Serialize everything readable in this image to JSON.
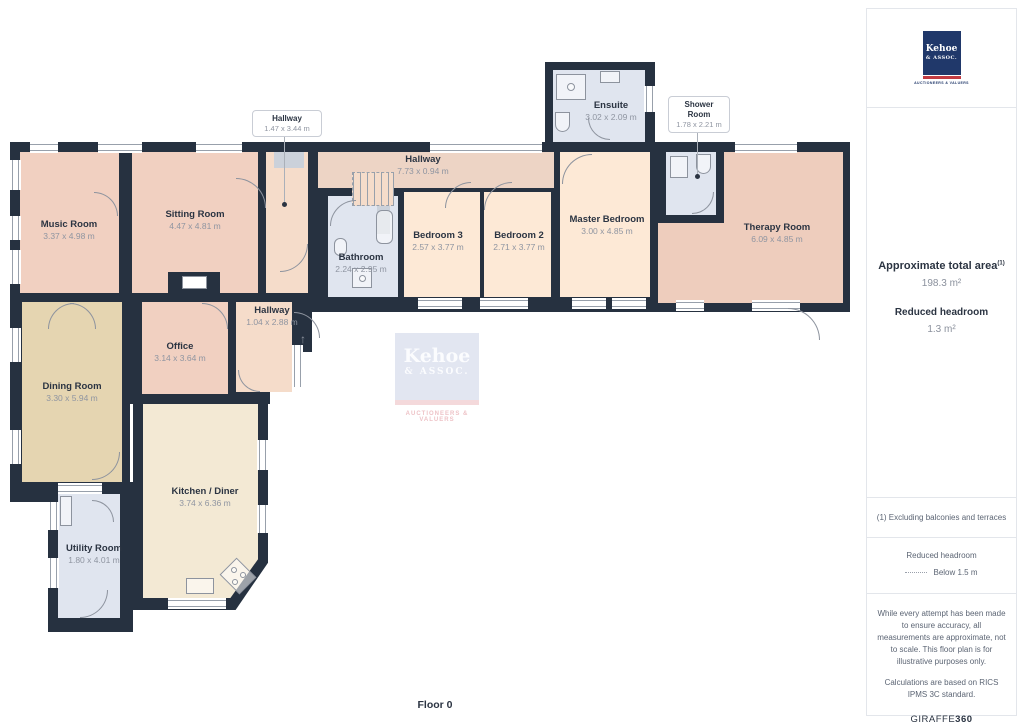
{
  "plan": {
    "floor_label": "Floor 0",
    "rooms": [
      {
        "id": "music-room",
        "name": "Music Room",
        "dims": "3.37 x 4.98 m"
      },
      {
        "id": "sitting-room",
        "name": "Sitting Room",
        "dims": "4.47 x 4.81 m"
      },
      {
        "id": "hallway-top",
        "name": "Hallway",
        "dims": "1.47 x 3.44 m"
      },
      {
        "id": "hallway-long",
        "name": "Hallway",
        "dims": "7.73 x 0.94 m"
      },
      {
        "id": "ensuite",
        "name": "Ensuite",
        "dims": "3.02 x 2.09 m"
      },
      {
        "id": "shower-room",
        "name": "Shower Room",
        "dims": "1.78 x 2.21 m"
      },
      {
        "id": "master-bedroom",
        "name": "Master Bedroom",
        "dims": "3.00 x 4.85 m"
      },
      {
        "id": "therapy-room",
        "name": "Therapy Room",
        "dims": "6.09 x 4.85 m"
      },
      {
        "id": "bedroom-3",
        "name": "Bedroom 3",
        "dims": "2.57 x 3.77 m"
      },
      {
        "id": "bedroom-2",
        "name": "Bedroom 2",
        "dims": "2.71 x 3.77 m"
      },
      {
        "id": "bathroom",
        "name": "Bathroom",
        "dims": "2.24 x 2.95 m"
      },
      {
        "id": "hallway-mid",
        "name": "Hallway",
        "dims": "1.04 x 2.88 m"
      },
      {
        "id": "office",
        "name": "Office",
        "dims": "3.14 x 3.64 m"
      },
      {
        "id": "dining-room",
        "name": "Dining Room",
        "dims": "3.30 x 5.94 m"
      },
      {
        "id": "kitchen-diner",
        "name": "Kitchen / Diner",
        "dims": "3.74 x 6.36 m"
      },
      {
        "id": "utility-room",
        "name": "Utility Room",
        "dims": "1.80 x 4.01 m"
      }
    ]
  },
  "watermark": {
    "line1": "Kehoe",
    "line2": "& ASSOC.",
    "tagline": "AUCTIONEERS & VALUERS"
  },
  "sidebar": {
    "logo": {
      "line1": "Kehoe",
      "line2": "& ASSOC.",
      "tagline": "AUCTIONEERS & VALUERS"
    },
    "area_title": "Approximate total area",
    "area_superscript": "(1)",
    "area_value": "198.3 m²",
    "headroom_title": "Reduced headroom",
    "headroom_value": "1.3 m²",
    "footnote": "(1) Excluding balconies and terraces",
    "legend_title": "Reduced headroom",
    "legend_value": "Below 1.5 m",
    "disclaimer1": "While every attempt has been made to ensure accuracy, all measurements are approximate, not to scale. This floor plan is for illustrative purposes only.",
    "disclaimer2": "Calculations are based on RICS IPMS 3C standard.",
    "brand": "GIRAFFE",
    "brand_suffix": "360"
  },
  "colors": {
    "wall": "#263140",
    "salmon": "#f1d0c1",
    "hall": "#f5dcca",
    "hall_long": "#edd4c5",
    "bedroom": "#fde9d6",
    "therapy": "#eecdbd",
    "dining": "#e5d5b1",
    "kitchen": "#f3e9d4",
    "wet_room": "#e0e5ef",
    "logo_navy": "#20386a",
    "logo_red": "#c23b42"
  }
}
